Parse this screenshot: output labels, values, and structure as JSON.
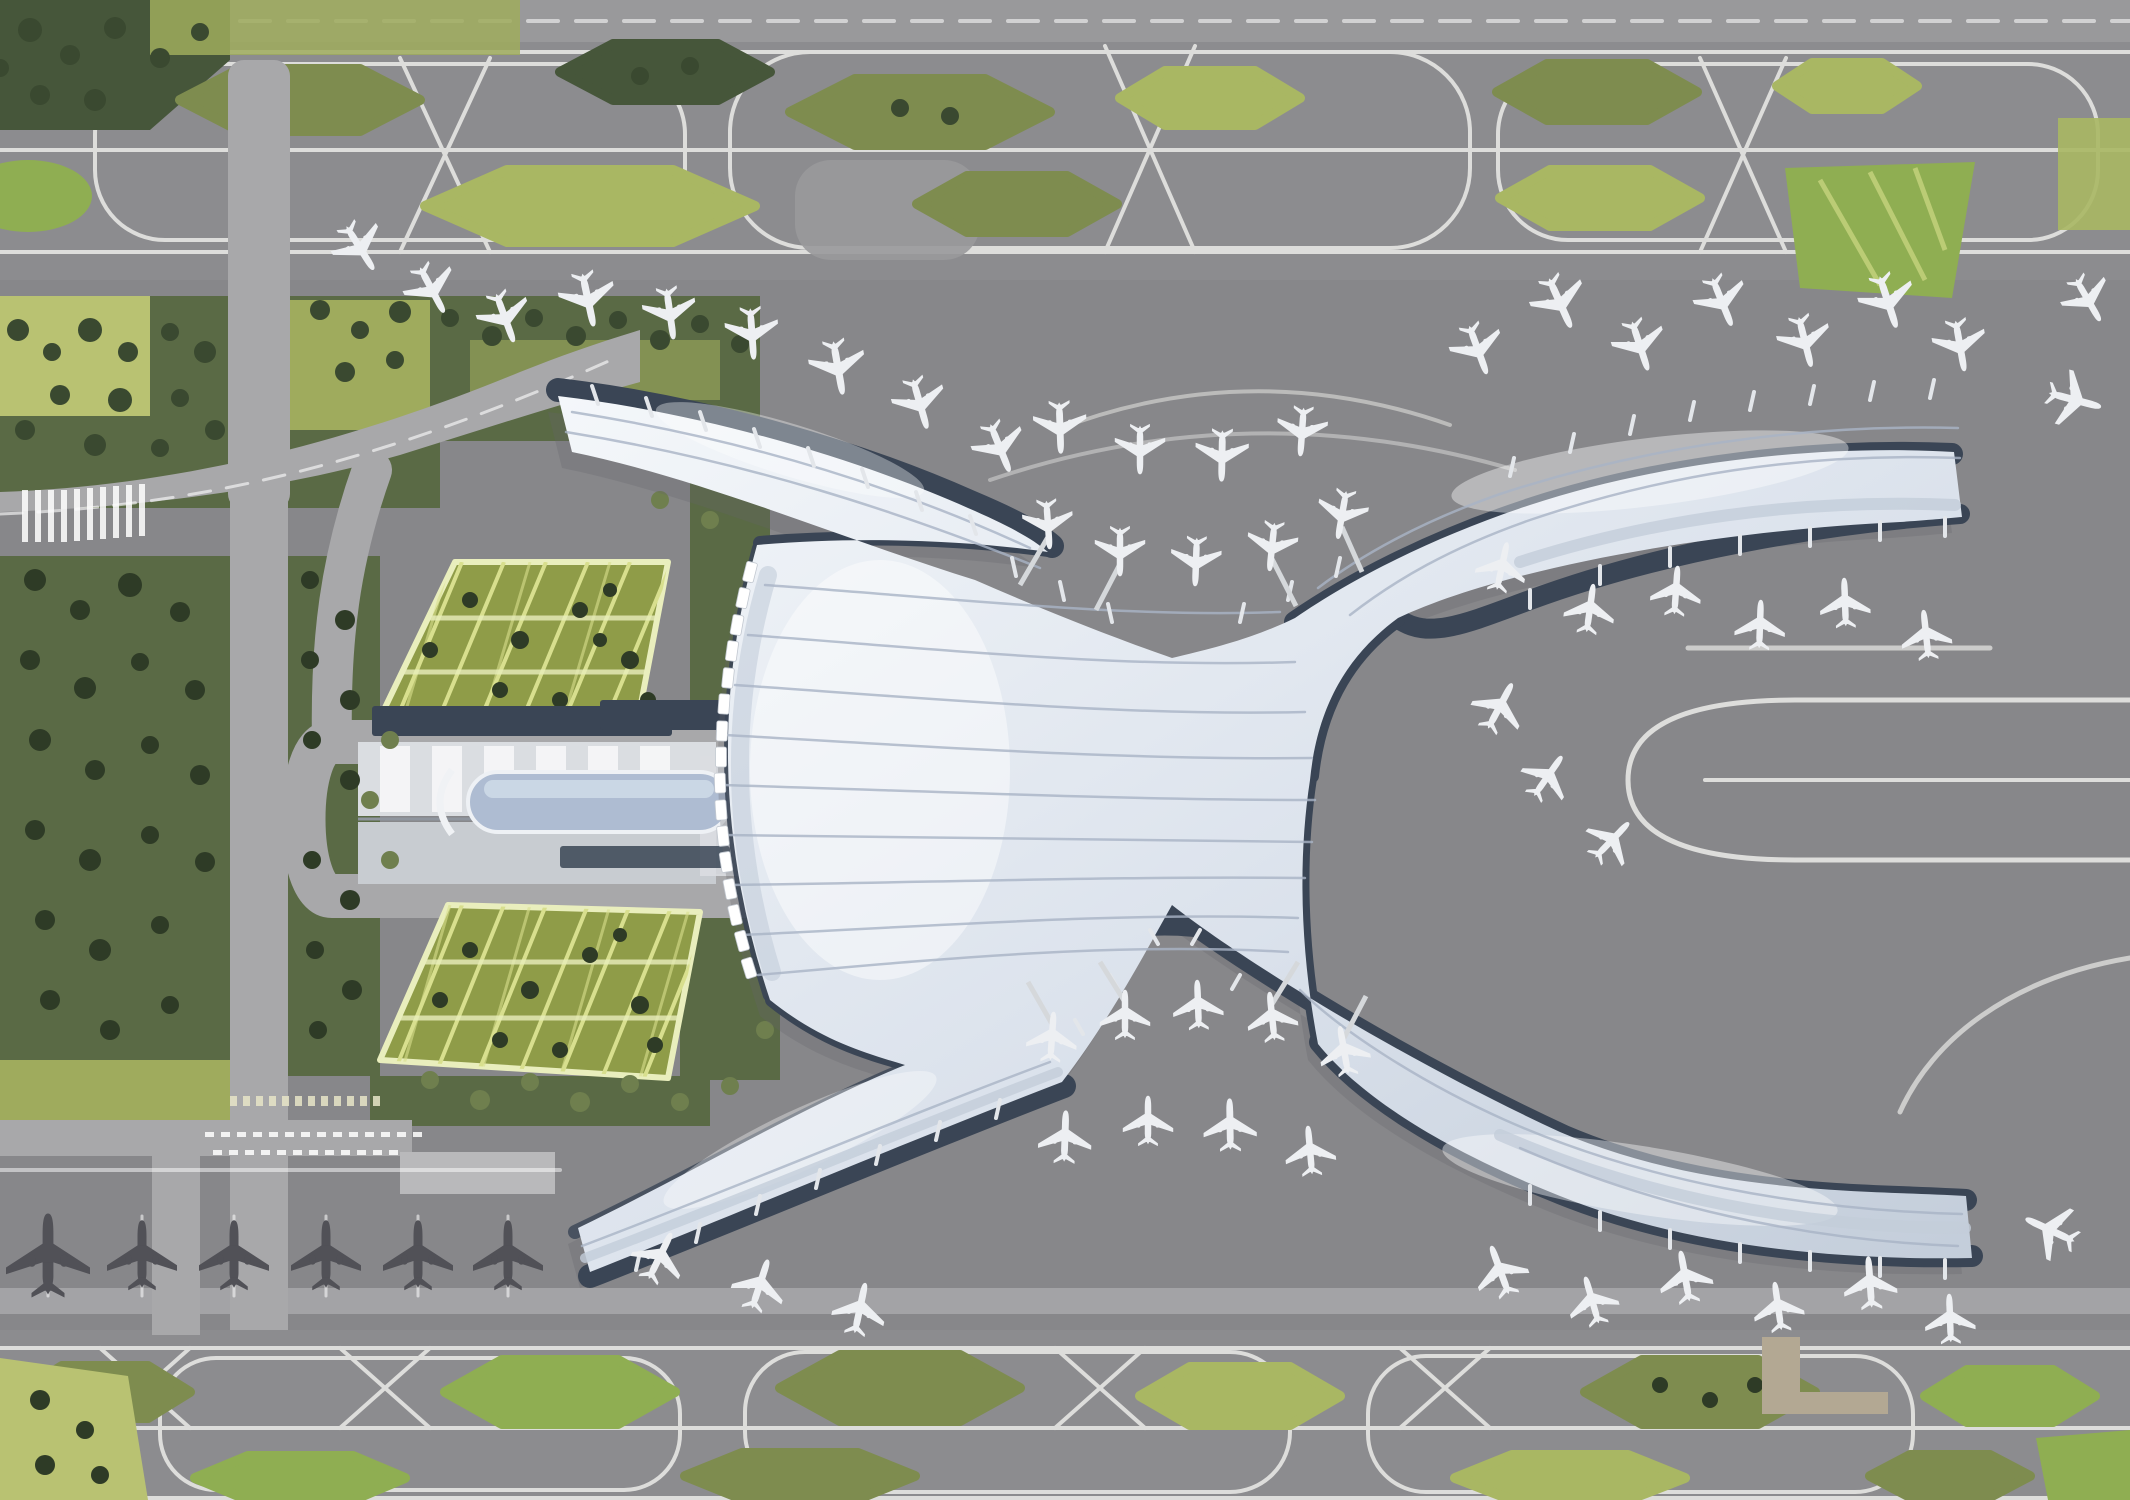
{
  "scene": {
    "subject": "Aerial rendering of a futuristic airport terminal with four curved concourse arms, a landside ground transport centre, green-roof car parks, taxiway loops with green islands and parked aircraft",
    "style": "architectural-rendering",
    "terminal": {
      "concourse_arms": 4,
      "dropoff_canopies": 16,
      "gate_coves": 3
    },
    "aircraft": {
      "at_gates": 55,
      "remote_stands": 6
    },
    "landside": {
      "green_roof_parking_structures": 2,
      "transport_centre_count": 1
    },
    "vegetation": {
      "taxiway_islands_top": 10,
      "taxiway_islands_bottom": 10
    }
  },
  "colors": {
    "bg": "#8c8c8f",
    "apron": "#87878a",
    "bandTop": "#99999b",
    "line": "#dddddb",
    "road": "#a8a8aa",
    "roadLight": "#b9b9bb",
    "roofHi": "#f4f7fa",
    "roofMid": "#dbe2ec",
    "roofShade": "#c3cdda",
    "ridge": "#a9b4c6",
    "navy": "#3a4555",
    "glass": "#aebcd2",
    "glassHi": "#cdd9e7",
    "gtcA": "#dadde1",
    "gtcB": "#c8ccd1",
    "forest": "#5a6a45",
    "forestDark": "#46563a",
    "tree1": "#3a4930",
    "tree2": "#2e3b26",
    "tree3": "#6f7f4e",
    "meadow": "#9fab5d",
    "meadowBright": "#b9c272",
    "olive": "#7e8c4f",
    "yellowGreen": "#a9b763",
    "green": "#8fae52",
    "grid": "#8f9c48",
    "gridLine": "#d8df8e",
    "gridOutline": "#e9eebd",
    "planeWhite": "#edeff2",
    "planeDark": "#515157",
    "tan": "#b3a893",
    "shadow": "#63636a"
  }
}
